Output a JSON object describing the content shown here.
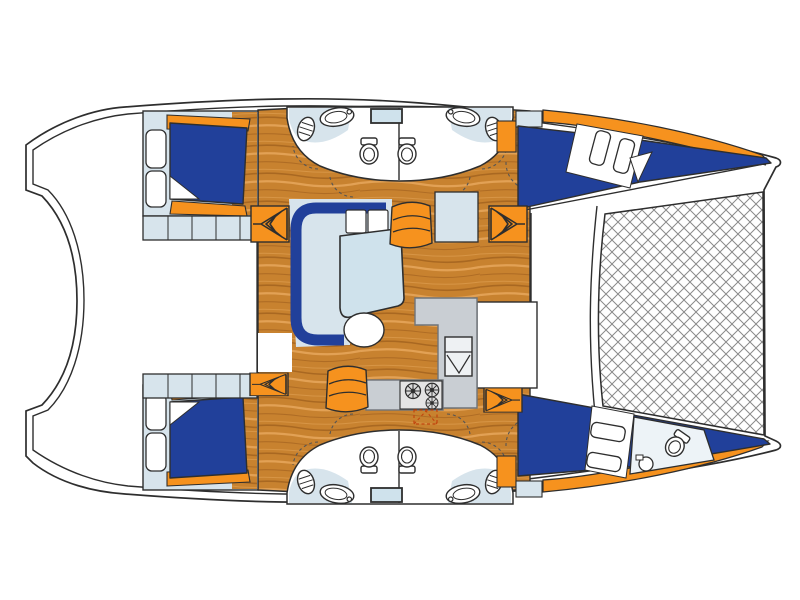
{
  "image": {
    "type": "boat-floor-plan",
    "subject": "Top-view deck layout of a 4-cabin sailing catamaran",
    "background": "#ffffff"
  },
  "colors": {
    "outline": "#2e2e2e",
    "wood": "#c8822f",
    "wood_dark": "#9e5e1c",
    "wood_light": "#e6a75c",
    "orange": "#f6921e",
    "navy": "#21409a",
    "navy_dark": "#16306e",
    "lightblue": "#d7e4ec",
    "table_blue": "#cfe2ec",
    "head_floor": "#edf3f7",
    "counter_gray": "#c9ced3",
    "counter_border": "#6f7479",
    "white": "#ffffff",
    "net_line": "#8a8a8a",
    "dash_accent": "#c1440e",
    "dash_gray": "#555555"
  },
  "components": {
    "berths": "double-berth",
    "toilet": "toilet",
    "basin": "washbasin",
    "stove": "three-burner-stove",
    "galley_sink": "double-galley-sink",
    "settee": "c-shaped-settee",
    "table": "saloon-table",
    "stool": "round-stool",
    "helm_seat": "curved-seat",
    "steps": "companionway-steps",
    "net": "bow-trampoline-net",
    "porthole": "porthole",
    "shelf": "shelf-locker",
    "hatch": "deck-hatch"
  },
  "counts": {
    "double_berths": 4,
    "toilets": 5,
    "washbasins": 5,
    "stove_burners": 3,
    "companionway_steps": 4,
    "portholes": 4,
    "curved_seats": 2,
    "trampolines": 1
  }
}
